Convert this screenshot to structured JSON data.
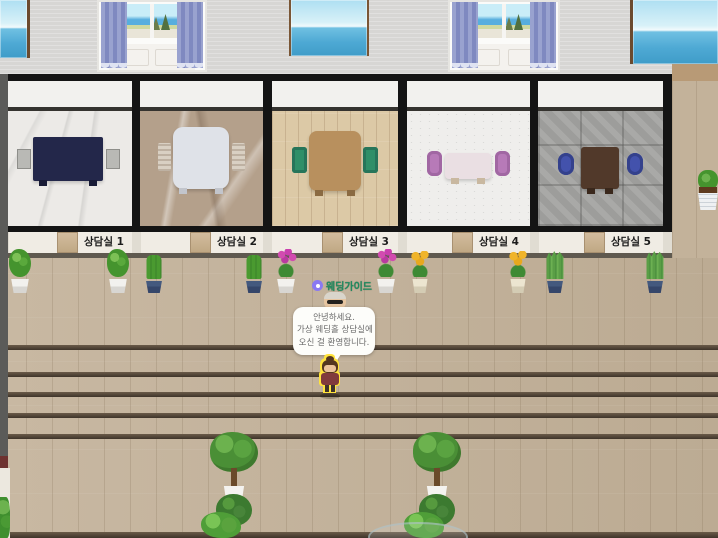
{
  "rooms": [
    {
      "label": "상담실 1",
      "floor": "white-marble",
      "table": "navy-rect-table",
      "chairs": "gray-side-stools",
      "table_color": "#23274a",
      "chair_color": "#b9b9b5"
    },
    {
      "label": "상담실 2",
      "floor": "beige-marble",
      "table": "white-rounded-table",
      "chairs": "beige-ribbed-chairs",
      "table_color": "#dfe2e8",
      "chair_color": "#d9d0c3"
    },
    {
      "label": "상담실 3",
      "floor": "light-wood-plank",
      "table": "wood-rounded-table",
      "chairs": "green-chairs",
      "table_color": "#b8905e",
      "chair_color": "#2f8f68"
    },
    {
      "label": "상담실 4",
      "floor": "white-stone",
      "table": "pink-small-table",
      "chairs": "purple-armchairs",
      "table_color": "#eadfe3",
      "chair_color": "#b77ab8"
    },
    {
      "label": "상담실 5",
      "floor": "gray-stone-tile",
      "table": "dark-wood-table",
      "chairs": "blue-round-chairs",
      "table_color": "#51392a",
      "chair_color": "#4352ac"
    }
  ],
  "npc": {
    "name": "웨딩가이드",
    "badge_icon": "member-badge-icon",
    "name_color": "#1f8a5f",
    "badge_color": "#8a79f2"
  },
  "speech_bubble": {
    "lines": [
      "안녕하세요.",
      "가상 웨딩홀 상담실에",
      "오신 걸 환영합니다."
    ]
  },
  "player": {
    "description": "player-avatar-selected",
    "highlight_color": "#ffe33c"
  },
  "windows": [
    {
      "type": "ocean-view-window"
    },
    {
      "type": "curtained-window"
    },
    {
      "type": "ocean-view-window"
    },
    {
      "type": "curtained-window"
    },
    {
      "type": "ocean-view-window"
    }
  ],
  "plants": [
    {
      "type": "leafy-bush",
      "pot": "white"
    },
    {
      "type": "leafy-bush",
      "pot": "white"
    },
    {
      "type": "cactus",
      "pot": "navy"
    },
    {
      "type": "cactus",
      "pot": "navy"
    },
    {
      "type": "pink-orchid",
      "pot": "white"
    },
    {
      "type": "pink-orchid",
      "pot": "white"
    },
    {
      "type": "sunflower",
      "pot": "cream"
    },
    {
      "type": "sunflower",
      "pot": "cream"
    },
    {
      "type": "snake-plant",
      "pot": "navy"
    },
    {
      "type": "snake-plant",
      "pot": "navy"
    }
  ],
  "decor": {
    "bottom_planter_clusters": 2,
    "wall_planter": "right-wall-planter",
    "glass_table": "bottom-center-glass-table",
    "stair_edges": 6
  },
  "palette": {
    "hall_floor_wood": "#c3b29a",
    "back_wall": "#d7d6d4",
    "room_wall_black": "#141414",
    "lower_wall_cream": "#f0ece4",
    "door": "#c9b391",
    "bubble_bg": "#fdfdfa",
    "bubble_text": "#6b6b6b",
    "stair_edge": "#3f342a"
  }
}
